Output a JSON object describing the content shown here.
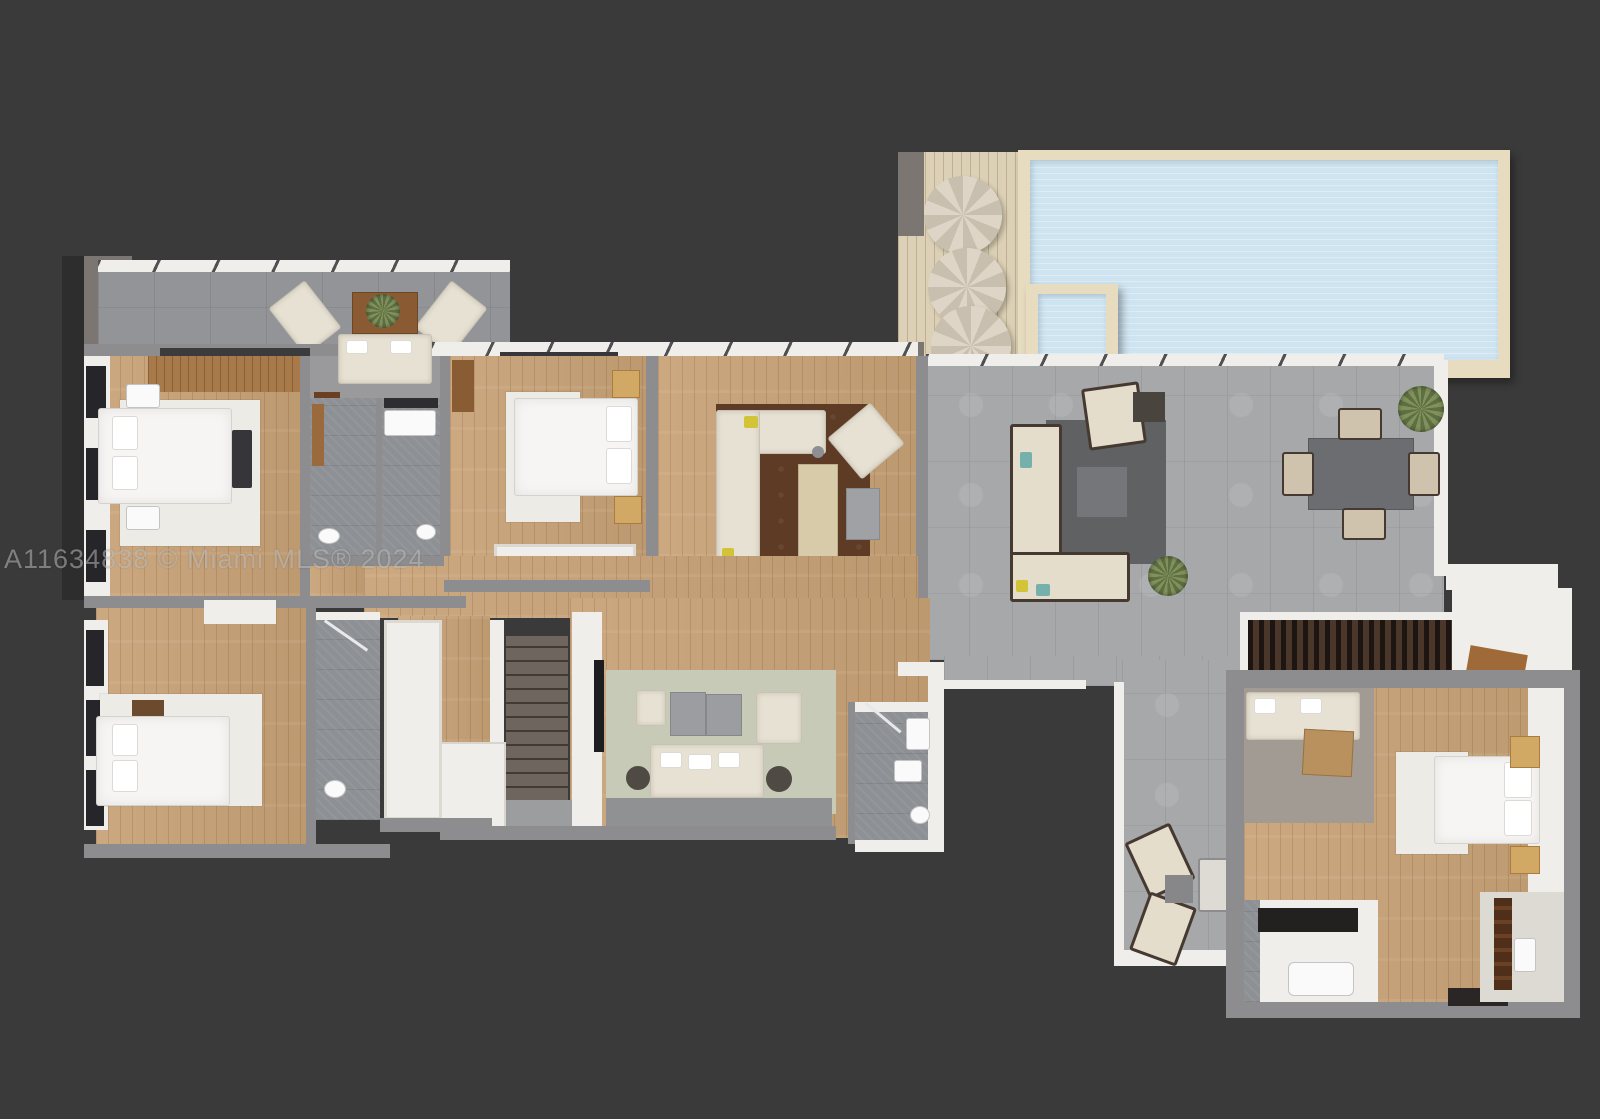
{
  "watermark": {
    "text": "A11634838 © Miami MLS® 2024"
  },
  "palette": {
    "background": "#3a3a3a",
    "wall_gray": "#8d8d8f",
    "wall_white": "#f0eeea",
    "wood_floor": "#c7a176",
    "deck_wood": "#dcd1b6",
    "tile_terrace": "#a7a8aa",
    "tile_balcony": "#939497",
    "tile_bath": "#8d9094",
    "pool_water": "#cfe4f1",
    "pool_deck": "#e7dcc0",
    "rug_brown": "#5d3b25",
    "rug_gray": "#5f6163",
    "rug_sage": "#c7cab7",
    "sofa_cream": "#e7e1d3",
    "furniture_dark": "#463931",
    "bed_white": "#f6f5f3",
    "stair_wood": "#6e655e",
    "accent_yellow": "#d3c337",
    "accent_teal": "#76b0ac",
    "plant_green": "#6d7c49",
    "watermark_color": "#b9b9b9"
  }
}
